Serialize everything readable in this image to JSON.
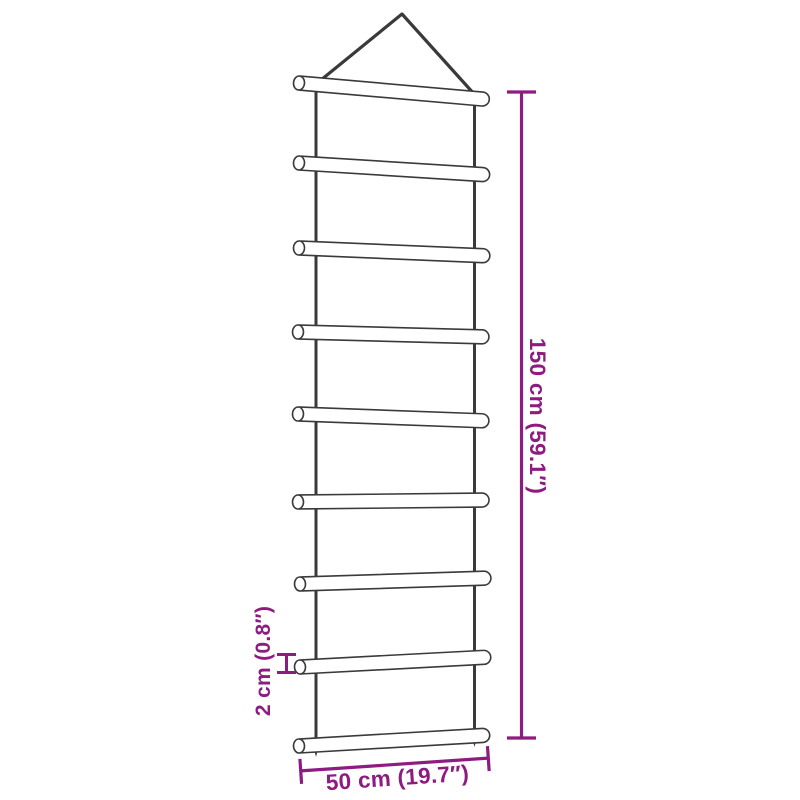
{
  "colors": {
    "background": "#ffffff",
    "ink": "#3a3a3a",
    "accent": "#8e1b80"
  },
  "ladder": {
    "rung_count": 9
  },
  "dimensions": {
    "height": {
      "label": "150 cm (59.1″)"
    },
    "width": {
      "label": "50 cm (19.7″)"
    },
    "rung_thickness": {
      "label": "2 cm (0.8″)"
    }
  }
}
